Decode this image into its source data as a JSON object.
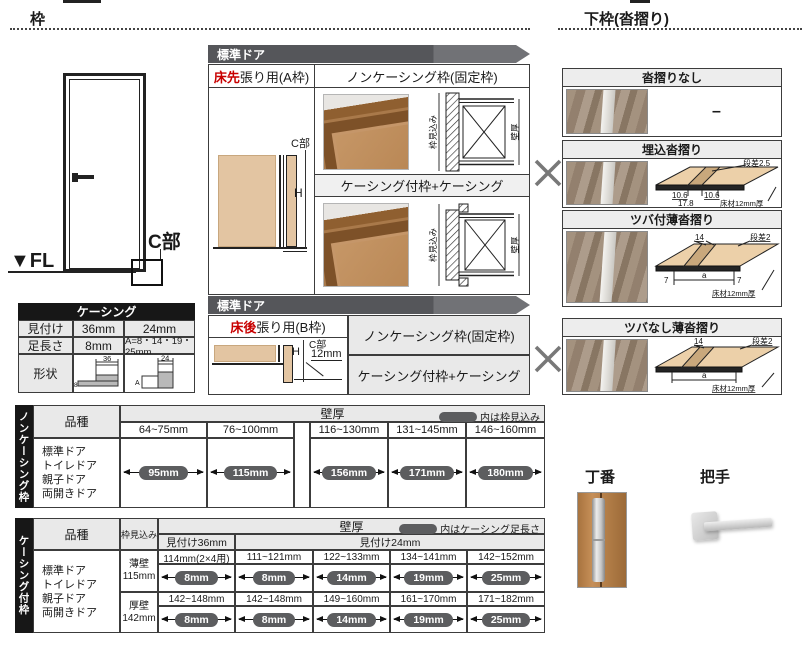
{
  "titles": {
    "left": "枠",
    "right": "下枠(沓摺り)"
  },
  "door_fig": {
    "fl": "▼FL",
    "c": "C部"
  },
  "std_banner": "標準ドア",
  "a_frame": {
    "tab_red": "床先",
    "tab_rest": "張り用(A枠)",
    "c": "C部",
    "h": "H",
    "noncasing_title": "ノンケーシング枠(固定枠)",
    "casing_title": "ケーシング付枠+ケーシング",
    "dim_jamb": "枠見込み",
    "dim_wall": "壁厚"
  },
  "b_frame": {
    "tab_red": "床後",
    "tab_rest": "張り用(B枠)",
    "c": "C部",
    "h": "H",
    "offset": "12mm",
    "noncasing_title": "ノンケーシング枠(固定枠)",
    "casing_title": "ケーシング付枠+ケーシング"
  },
  "sills": {
    "none": {
      "title": "沓摺りなし",
      "value": "–"
    },
    "umekomi": {
      "title": "埋込沓摺り",
      "step": "段差2.5",
      "d1": "10.6",
      "d2": "10.6",
      "d3": "17.8",
      "floor": "床材12mm厚"
    },
    "tsuba": {
      "title": "ツバ付薄沓摺り",
      "w": "14",
      "step": "段差2",
      "e1": "7",
      "a": "a",
      "e2": "7",
      "floor": "床材12mm厚"
    },
    "notsuba": {
      "title": "ツバなし薄沓摺り",
      "w": "14",
      "step": "段差2",
      "a": "a",
      "floor": "床材12mm厚"
    }
  },
  "casing_spec": {
    "title": "ケーシング",
    "r1_label": "見付け",
    "r1_v36": "36mm",
    "r1_v24": "24mm",
    "r2_label": "足長さ",
    "r2_v36": "8mm",
    "r2_v24": "A=8・14・19・25mm",
    "r3_label": "形状",
    "s36_top": "36",
    "s36_side": "8",
    "s24_top": "24",
    "s24_side": "A"
  },
  "table1": {
    "side": "ノンケーシング枠",
    "col_kind": "品種",
    "col_wall": "壁厚",
    "legend": "内は枠見込み",
    "ranges": [
      "64~75mm",
      "76~100mm",
      "116~130mm",
      "131~145mm",
      "146~160mm"
    ],
    "kinds": [
      "標準ドア",
      "トイレドア",
      "親子ドア",
      "両開きドア"
    ],
    "values": [
      "95mm",
      "115mm",
      "156mm",
      "171mm",
      "180mm"
    ]
  },
  "table2": {
    "side": "ケーシング付枠",
    "col_kind": "品種",
    "col_depth": "枠見込み",
    "col_wall": "壁厚",
    "legend": "内はケーシング足長さ",
    "mitsuke36": "見付け36mm",
    "mitsuke24": "見付け24mm",
    "kinds": [
      "標準ドア",
      "トイレドア",
      "親子ドア",
      "両開きドア"
    ],
    "rows": [
      {
        "wall_type": "薄壁",
        "depth": "115mm",
        "ranges": [
          "114mm(2×4用)",
          "111~121mm",
          "122~133mm",
          "134~141mm",
          "142~152mm"
        ],
        "values": [
          "8mm",
          "8mm",
          "14mm",
          "19mm",
          "25mm"
        ]
      },
      {
        "wall_type": "厚壁",
        "depth": "142mm",
        "ranges": [
          "142~148mm",
          "142~148mm",
          "149~160mm",
          "161~170mm",
          "171~182mm"
        ],
        "values": [
          "8mm",
          "8mm",
          "14mm",
          "19mm",
          "25mm"
        ]
      }
    ]
  },
  "hardware": {
    "hinge": "丁番",
    "handle": "把手"
  }
}
